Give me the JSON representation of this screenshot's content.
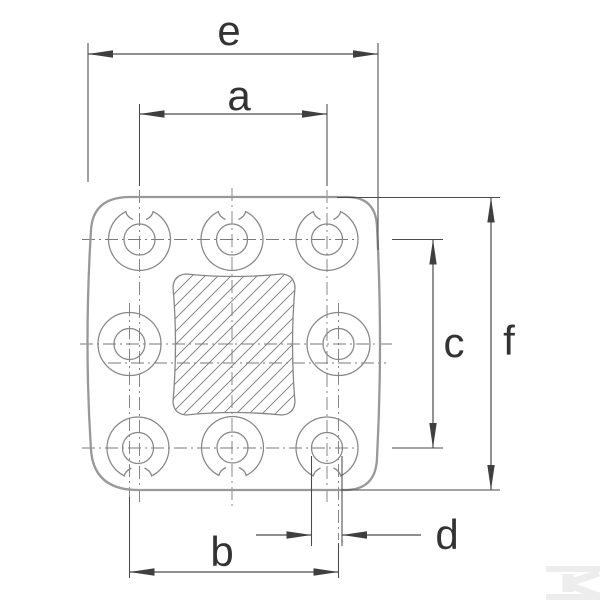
{
  "drawing": {
    "type": "technical-dimension-drawing",
    "subject": "square mounting plate, 8 bolt holes, hatched center block"
  },
  "dimensions": {
    "e": "e",
    "a": "a",
    "c": "c",
    "f": "f",
    "b": "b",
    "d": "d"
  },
  "watermark": {
    "name": "kramp-logo"
  },
  "colors": {
    "background": "#ffffff",
    "plate_outline": "#999999",
    "feature_lines": "#868686",
    "centerlines": "#7a7a7a",
    "dimension_lines": "#4a4a4a",
    "label_text": "#333333",
    "hatch": "#7a7a7a",
    "watermark": "#ededed"
  }
}
